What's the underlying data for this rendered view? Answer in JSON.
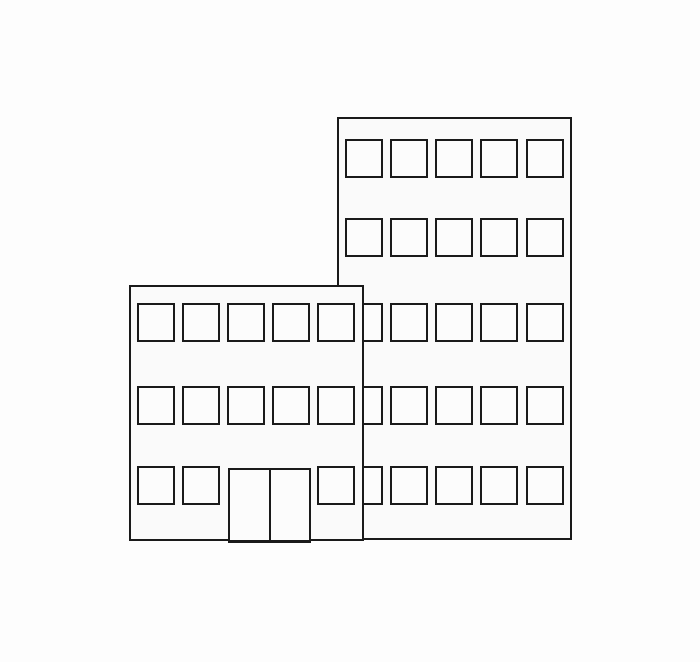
{
  "canvas": {
    "width": 700,
    "height": 662,
    "background": "#fdfdfd"
  },
  "style": {
    "stroke_color": "#1a1a1a",
    "building_fill": "#fafafa",
    "window_fill": "#fcfcfc",
    "door_fill": "#fcfcfc"
  },
  "scene": {
    "description": "line drawing of two office buildings with square windows",
    "buildings": [
      {
        "name": "tall-building",
        "x": 337,
        "y": 117,
        "width": 235,
        "height": 423,
        "z": 1,
        "window_size": {
          "w": 38,
          "h": 39
        },
        "col_offsets": [
          6,
          51,
          96,
          141,
          187
        ],
        "rows": [
          {
            "y": 20,
            "cols": [
              0,
              1,
              2,
              3,
              4
            ]
          },
          {
            "y": 99,
            "cols": [
              0,
              1,
              2,
              3,
              4
            ]
          },
          {
            "y": 184,
            "cols": [
              0,
              1,
              2,
              3,
              4
            ]
          },
          {
            "y": 267,
            "cols": [
              0,
              1,
              2,
              3,
              4
            ]
          },
          {
            "y": 347,
            "cols": [
              0,
              1,
              2,
              3,
              4
            ]
          }
        ],
        "door": null
      },
      {
        "name": "short-building",
        "x": 129,
        "y": 285,
        "width": 235,
        "height": 256,
        "z": 2,
        "window_size": {
          "w": 38,
          "h": 39
        },
        "col_offsets": [
          6,
          51,
          96,
          141,
          186
        ],
        "rows": [
          {
            "y": 16,
            "cols": [
              0,
              1,
              2,
              3,
              4
            ]
          },
          {
            "y": 99,
            "cols": [
              0,
              1,
              2,
              3,
              4
            ]
          },
          {
            "y": 179,
            "cols": [
              0,
              1,
              4
            ]
          }
        ],
        "door": {
          "x": 97,
          "y": 181,
          "w": 83,
          "h": 75,
          "panels": 2
        }
      }
    ]
  }
}
